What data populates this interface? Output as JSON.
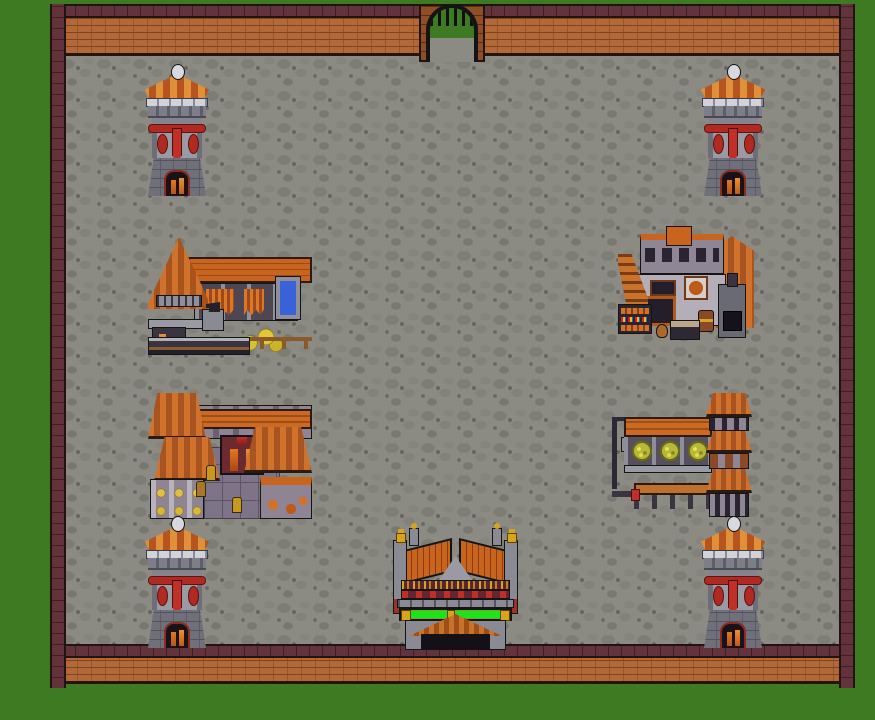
{
  "meta": {
    "title": "Walled market town — overhead pixel-art view",
    "view": "top-down 2D RPG town map",
    "canvas": {
      "width": 875,
      "height": 720
    }
  },
  "palette": {
    "grass": "#3e7a22",
    "floor": "#8b8b84",
    "floor_stone": "#7d7d76",
    "brick": "#b26838",
    "brick_mortar": "#7e441e",
    "cap": "#63323a",
    "outline": "#1f1410",
    "tower_body": "#8e8e98",
    "roof_orange": "#c8641e",
    "roof_light": "#e09038",
    "accent_red": "#b02a22",
    "gold": "#d8a41c",
    "greenbar": "#1ae51a",
    "blue_door": "#3a62d8"
  },
  "scene": {
    "outside": {
      "id": "grass-outside",
      "label": "grass outside walls"
    },
    "courtyard": {
      "id": "courtyard-floor",
      "label": "cobblestone courtyard"
    },
    "walls": [
      {
        "id": "wall-top",
        "label": "north brick wall"
      },
      {
        "id": "wall-bottom",
        "label": "south brick wall"
      },
      {
        "id": "wall-left",
        "label": "west brick wall"
      },
      {
        "id": "wall-right",
        "label": "east brick wall"
      }
    ],
    "gate": {
      "id": "north-gate",
      "label": "arched north gate with portcullis",
      "x": 419,
      "y": 4,
      "w": 66,
      "h": 58
    },
    "towers": [
      {
        "id": "tower-top-left",
        "label": "watchtower",
        "x": 140,
        "y": 64
      },
      {
        "id": "tower-top-right",
        "label": "watchtower",
        "x": 696,
        "y": 64
      },
      {
        "id": "tower-bottom-left",
        "label": "watchtower",
        "x": 140,
        "y": 516
      },
      {
        "id": "tower-bottom-right",
        "label": "watchtower",
        "x": 696,
        "y": 516
      }
    ],
    "buildings": [
      {
        "id": "blacksmith-stall",
        "label": "blacksmith stall with forge, anvil, blue door and gold pile",
        "x": 148,
        "y": 233,
        "w": 164,
        "h": 122
      },
      {
        "id": "general-shop",
        "label": "two-story shop with stairs, goods stand, stove and barrels",
        "x": 618,
        "y": 226,
        "w": 136,
        "h": 120
      },
      {
        "id": "market-hall",
        "label": "market hall with hip roofs, tiled court and jar shelves",
        "x": 148,
        "y": 393,
        "w": 164,
        "h": 127
      },
      {
        "id": "produce-stall",
        "label": "produce stall with canopy, wreaths, long table and roof tower",
        "x": 612,
        "y": 393,
        "w": 140,
        "h": 124
      },
      {
        "id": "south-hall",
        "label": "ornate south entrance hall with glowing green banner",
        "x": 393,
        "y": 528,
        "w": 125,
        "h": 122
      }
    ]
  }
}
